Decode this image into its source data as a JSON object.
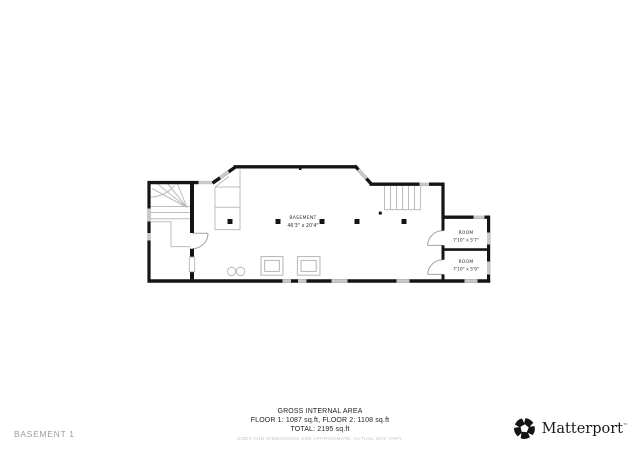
{
  "plan": {
    "basement_label": "BASEMENT",
    "basement_dims": "46'3\" x 20'4\"",
    "room1_label": "ROOM",
    "room1_dims": "7'10\" x 5'7\"",
    "room2_label": "ROOM",
    "room2_dims": "7'10\" x 5'9\""
  },
  "footer": {
    "gross_area_title": "GROSS INTERNAL AREA",
    "floors_line": "FLOOR 1: 1087 sq.ft, FLOOR 2: 1108 sq.ft",
    "total_line": "TOTAL: 2195 sq.ft",
    "disclaimer": "SIZES AND DIMENSIONS ARE APPROXIMATE, ACTUAL MAY VARY."
  },
  "status_bar": {
    "floor_label": "BASEMENT 1"
  },
  "brand": {
    "name": "Matterport",
    "trademark": "™"
  },
  "colors": {
    "wall": "#141414",
    "window": "#c9c9c9",
    "detail": "#b6b6b6",
    "label_text": "#2e2e2e",
    "muted_text": "#9d9d9d",
    "disclaimer_text": "#c3c3c3"
  }
}
